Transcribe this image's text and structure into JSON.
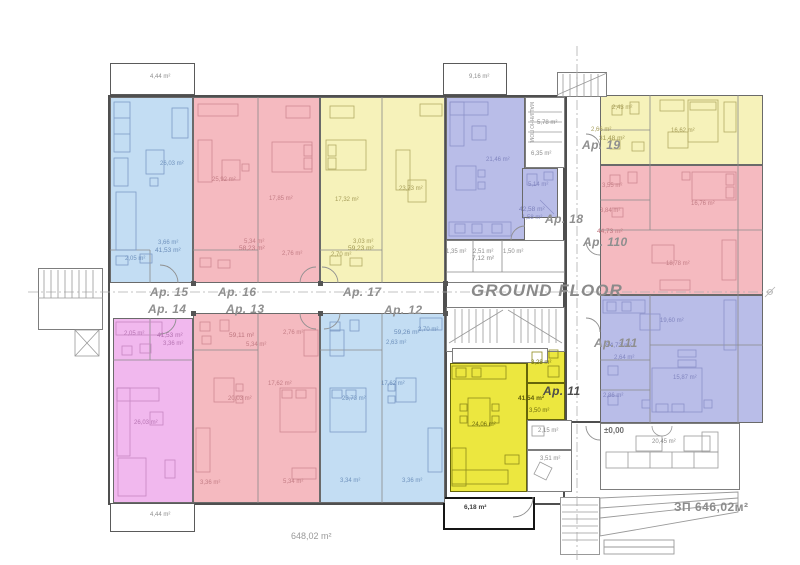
{
  "title": "GROUND FLOOR",
  "totals": {
    "floor_area": "648,02 m²",
    "built_up_area": "ЗП 646,02м²",
    "level_mark": "±0,00"
  },
  "apartments": [
    {
      "id": "ap15",
      "label": "Ap. 15",
      "total_area": "41,53 m²",
      "color": "#c3ddf3"
    },
    {
      "id": "ap16",
      "label": "Ap. 16",
      "total_area": "58,23 m²",
      "color": "#f5bac0"
    },
    {
      "id": "ap17",
      "label": "Ap. 17",
      "total_area": "59,23 m²",
      "color": "#f6f2ba"
    },
    {
      "id": "ap14",
      "label": "Ap. 14",
      "total_area": "41,53 m²",
      "color": "#f1b8ee"
    },
    {
      "id": "ap13",
      "label": "Ap. 13",
      "total_area": "59,11 m²",
      "color": "#f5bac0"
    },
    {
      "id": "ap12",
      "label": "Ap. 12",
      "total_area": "59,26 m²",
      "color": "#c3ddf3"
    },
    {
      "id": "ap11",
      "label": "Ap. 11",
      "total_area": "41,54 m²",
      "color": "#ece73f"
    },
    {
      "id": "ap18",
      "label": "Ap. 18",
      "total_area": "42,58 m²",
      "color": "#b9bde8"
    },
    {
      "id": "ap19",
      "label": "Ap. 19",
      "total_area": "31,48 m²",
      "color": "#f6f2ba"
    },
    {
      "id": "ap110",
      "label": "Ap. 110",
      "total_area": "44,73 m²",
      "color": "#f5bac0"
    },
    {
      "id": "ap111",
      "label": "Ap. 111",
      "total_area": "54,73 m²",
      "color": "#b9bde8"
    }
  ],
  "common": {
    "machine_room_label": "МАШИННО ПОМ.",
    "lounge_area": "20,45 m²",
    "porch_area": "6,18 m²"
  },
  "area_labels": [
    {
      "t": "26,03 m²",
      "x": 160,
      "y": 161,
      "c": "b"
    },
    {
      "t": "3,66 m²",
      "x": 158,
      "y": 240,
      "c": "b"
    },
    {
      "t": "41,53 m²",
      "x": 155,
      "y": 248,
      "c": "bs"
    },
    {
      "t": "2,05 m²",
      "x": 125,
      "y": 256,
      "c": "b"
    },
    {
      "t": "25,92 m²",
      "x": 212,
      "y": 177,
      "c": "r"
    },
    {
      "t": "17,85 m²",
      "x": 269,
      "y": 196,
      "c": "r"
    },
    {
      "t": "5,34 m²",
      "x": 244,
      "y": 239,
      "c": "r"
    },
    {
      "t": "58,23 m²",
      "x": 239,
      "y": 246,
      "c": "rs"
    },
    {
      "t": "2,76 m²",
      "x": 282,
      "y": 251,
      "c": "r"
    },
    {
      "t": "23,73 m²",
      "x": 399,
      "y": 186,
      "c": "y"
    },
    {
      "t": "17,32 m²",
      "x": 335,
      "y": 197,
      "c": "y"
    },
    {
      "t": "3,03 m²",
      "x": 353,
      "y": 239,
      "c": "y"
    },
    {
      "t": "59,23 m²",
      "x": 348,
      "y": 246,
      "c": "ys"
    },
    {
      "t": "2,70 m²",
      "x": 331,
      "y": 252,
      "c": "y"
    },
    {
      "t": "21,46 m²",
      "x": 486,
      "y": 157,
      "c": "p"
    },
    {
      "t": "5,14 m²",
      "x": 528,
      "y": 182,
      "c": "p"
    },
    {
      "t": "42,58 m²",
      "x": 519,
      "y": 207,
      "c": "ps"
    },
    {
      "t": "1,58 m²",
      "x": 522,
      "y": 215,
      "c": "p"
    },
    {
      "t": "5,78 m²",
      "x": 537,
      "y": 120,
      "c": "g"
    },
    {
      "t": "6,35 m²",
      "x": 531,
      "y": 151,
      "c": "g"
    },
    {
      "t": "1,35 m²",
      "x": 446,
      "y": 249,
      "c": "g"
    },
    {
      "t": "2,51 m²",
      "x": 473,
      "y": 249,
      "c": "g"
    },
    {
      "t": "1,50 m²",
      "x": 503,
      "y": 249,
      "c": "g"
    },
    {
      "t": "7,12 m²",
      "x": 472,
      "y": 256,
      "c": "gs"
    },
    {
      "t": "2,43 m²",
      "x": 612,
      "y": 105,
      "c": "y"
    },
    {
      "t": "2,66 m²",
      "x": 591,
      "y": 127,
      "c": "y"
    },
    {
      "t": "31,48 m²",
      "x": 599,
      "y": 136,
      "c": "ys"
    },
    {
      "t": "16,62 m²",
      "x": 671,
      "y": 128,
      "c": "y"
    },
    {
      "t": "3,55 m²",
      "x": 602,
      "y": 183,
      "c": "r"
    },
    {
      "t": "3,84 m²",
      "x": 600,
      "y": 208,
      "c": "r"
    },
    {
      "t": "16,76 m²",
      "x": 691,
      "y": 201,
      "c": "r"
    },
    {
      "t": "44,73 m²",
      "x": 597,
      "y": 229,
      "c": "rs"
    },
    {
      "t": "18,78 m²",
      "x": 666,
      "y": 261,
      "c": "r"
    },
    {
      "t": "19,60 m²",
      "x": 660,
      "y": 318,
      "c": "p"
    },
    {
      "t": "54,73 m²",
      "x": 606,
      "y": 343,
      "c": "ps"
    },
    {
      "t": "2,64 m²",
      "x": 614,
      "y": 355,
      "c": "p"
    },
    {
      "t": "15,87 m²",
      "x": 673,
      "y": 375,
      "c": "p"
    },
    {
      "t": "2,86 m²",
      "x": 603,
      "y": 393,
      "c": "p"
    },
    {
      "t": "2,05 m²",
      "x": 124,
      "y": 331,
      "c": "m"
    },
    {
      "t": "41,53 m²",
      "x": 157,
      "y": 333,
      "c": "ms"
    },
    {
      "t": "3,36 m²",
      "x": 163,
      "y": 341,
      "c": "m"
    },
    {
      "t": "26,03 m²",
      "x": 134,
      "y": 420,
      "c": "m"
    },
    {
      "t": "59,11 m²",
      "x": 229,
      "y": 333,
      "c": "rs"
    },
    {
      "t": "5,34 m²",
      "x": 246,
      "y": 342,
      "c": "r"
    },
    {
      "t": "2,76 m²",
      "x": 283,
      "y": 330,
      "c": "r"
    },
    {
      "t": "20,03 m²",
      "x": 228,
      "y": 396,
      "c": "r"
    },
    {
      "t": "17,62 m²",
      "x": 268,
      "y": 381,
      "c": "r"
    },
    {
      "t": "3,36 m²",
      "x": 200,
      "y": 480,
      "c": "r"
    },
    {
      "t": "5,34 m²",
      "x": 283,
      "y": 479,
      "c": "r"
    },
    {
      "t": "59,26 m²",
      "x": 394,
      "y": 330,
      "c": "bs"
    },
    {
      "t": "2,70 m²",
      "x": 418,
      "y": 327,
      "c": "b"
    },
    {
      "t": "2,63 m²",
      "x": 386,
      "y": 340,
      "c": "b"
    },
    {
      "t": "17,62 m²",
      "x": 381,
      "y": 381,
      "c": "b"
    },
    {
      "t": "23,73 m²",
      "x": 342,
      "y": 396,
      "c": "b"
    },
    {
      "t": "3,34 m²",
      "x": 340,
      "y": 478,
      "c": "b"
    },
    {
      "t": "3,36 m²",
      "x": 402,
      "y": 478,
      "c": "b"
    },
    {
      "t": "3,28 m²",
      "x": 531,
      "y": 360,
      "c": "k"
    },
    {
      "t": "41,54 m²",
      "x": 518,
      "y": 396,
      "c": "ks"
    },
    {
      "t": "3,50 m²",
      "x": 529,
      "y": 408,
      "c": "k"
    },
    {
      "t": "24,06 m²",
      "x": 472,
      "y": 422,
      "c": "k"
    },
    {
      "t": "2,15 m²",
      "x": 538,
      "y": 428,
      "c": "g"
    },
    {
      "t": "3,51 m²",
      "x": 540,
      "y": 456,
      "c": "g"
    },
    {
      "t": "6,18 m²",
      "x": 464,
      "y": 505,
      "c": "d"
    },
    {
      "t": "20,45 m²",
      "x": 652,
      "y": 439,
      "c": "g"
    },
    {
      "t": "4,44 m²",
      "x": 150,
      "y": 74,
      "c": "g"
    },
    {
      "t": "9,16 m²",
      "x": 469,
      "y": 74,
      "c": "g"
    },
    {
      "t": "4,44 m²",
      "x": 150,
      "y": 512,
      "c": "g"
    }
  ]
}
